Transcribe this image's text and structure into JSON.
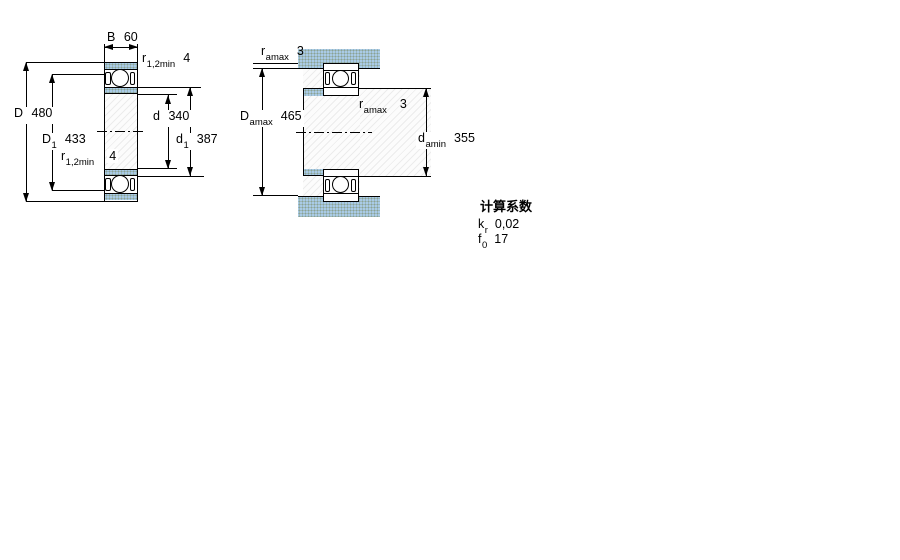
{
  "colors": {
    "section_fill_blue": "#a9cbe6",
    "outline": "#000000",
    "background": "#ffffff"
  },
  "left_view": {
    "dims": {
      "B": {
        "symbol": "B",
        "subscript": "",
        "value": "60"
      },
      "r12_top": {
        "symbol": "r",
        "subscript": "1,2min",
        "value": "4"
      },
      "D": {
        "symbol": "D",
        "subscript": "",
        "value": "480"
      },
      "D1": {
        "symbol": "D",
        "subscript": "1",
        "value": "433"
      },
      "r12_mid": {
        "symbol": "r",
        "subscript": "1,2min",
        "value": "4"
      },
      "d": {
        "symbol": "d",
        "subscript": "",
        "value": "340"
      },
      "d1": {
        "symbol": "d",
        "subscript": "1",
        "value": "387"
      }
    }
  },
  "right_view": {
    "dims": {
      "ra_top": {
        "symbol": "r",
        "subscript": "amax",
        "value": "3"
      },
      "Da": {
        "symbol": "D",
        "subscript": "amax",
        "value": "465"
      },
      "ra_mid": {
        "symbol": "r",
        "subscript": "amax",
        "value": "3"
      },
      "da": {
        "symbol": "d",
        "subscript": "amin",
        "value": "355"
      }
    }
  },
  "calculation_factors": {
    "title": "计算系数",
    "rows": [
      {
        "symbol": "k",
        "subscript": "r",
        "value": "0,02"
      },
      {
        "symbol": "f",
        "subscript": "0",
        "value": "17"
      }
    ]
  }
}
